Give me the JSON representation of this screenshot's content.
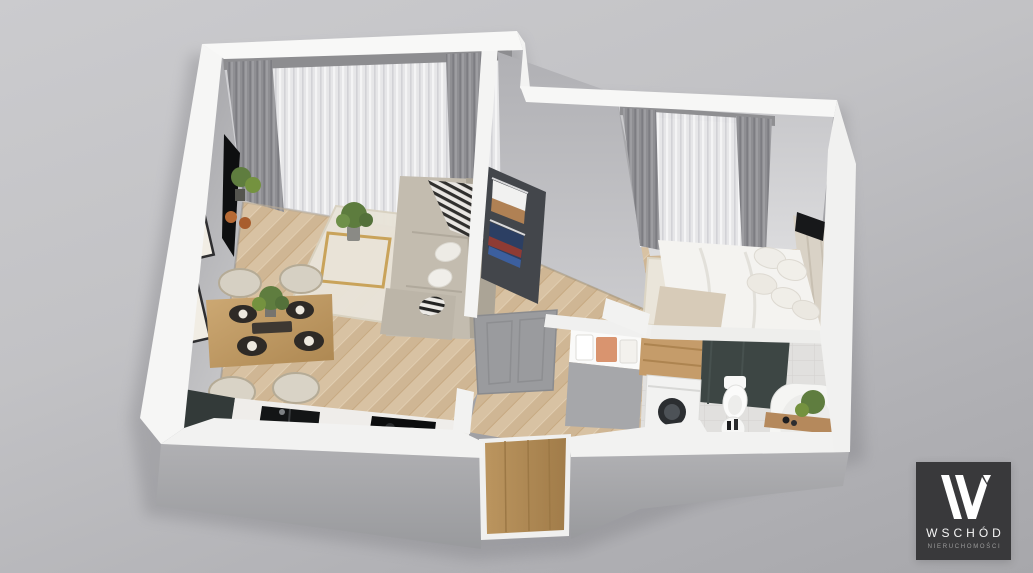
{
  "watermark": {
    "brand": "WSCHÓD",
    "tagline": "NIERUCHOMOŚCI"
  },
  "scene": {
    "type": "3d-floor-plan-render",
    "view": "isometric dollhouse cutaway of a one-bedroom apartment",
    "rooms": [
      {
        "name": "living-room",
        "features": [
          "corner-sofa",
          "black-white-throw-pillows",
          "gold-coffee-table",
          "potted-plant",
          "tv-on-side-wall",
          "wall-art-frames",
          "sheer-curtains",
          "gray-drapes",
          "cream-area-rug"
        ]
      },
      {
        "name": "dining-area",
        "features": [
          "wood-dining-table",
          "four-cream-chairs",
          "dark-place-settings",
          "centerpiece-plant"
        ]
      },
      {
        "name": "kitchen",
        "features": [
          "white-counter-run",
          "black-sink",
          "black-cooktop",
          "graphite-corner-counter"
        ]
      },
      {
        "name": "hallway",
        "features": [
          "open-wardrobe-with-hanging-clothes",
          "gray-interior-door",
          "towel-shelf",
          "wood-entrance-door"
        ]
      },
      {
        "name": "bedroom",
        "features": [
          "double-bed-white-bedding",
          "upholstered-headboard",
          "pillow-stack",
          "beige-throw",
          "window-sheers-and-drapes",
          "wall-tv",
          "patterned-rug"
        ]
      },
      {
        "name": "bathroom",
        "features": [
          "washing-machine",
          "wood-cabinet",
          "dark-shower-panel",
          "toilet",
          "round-side-table",
          "bathtub",
          "wood-bath-tray",
          "green-plant"
        ]
      }
    ],
    "floor_material": "light oak herringbone parquet",
    "wall_finish": "white walls with gray interior faces"
  },
  "palette": {
    "background_top": "#cbcbce",
    "background_bottom": "#a7a7ab",
    "wall_white": "#f6f6f5",
    "wall_gray_face": "#a8a8ab",
    "exterior_shadow_face": "#9d9da0",
    "floor_wood": "#d6c0a1",
    "rug_cream": "#e9e4d9",
    "sofa_beige": "#c3bcaf",
    "drape_gray": "#8f8f93",
    "counter_dark": "#333a39",
    "appliance_black": "#101112",
    "table_wood": "#c3a06c",
    "door_wood": "#b3905f",
    "plant_green": "#5f7d3f",
    "accent_gold": "#c9a35a",
    "logo_bg": "#39393b",
    "logo_text": "#f5f5f5",
    "logo_tagline": "#9c9c9c"
  }
}
